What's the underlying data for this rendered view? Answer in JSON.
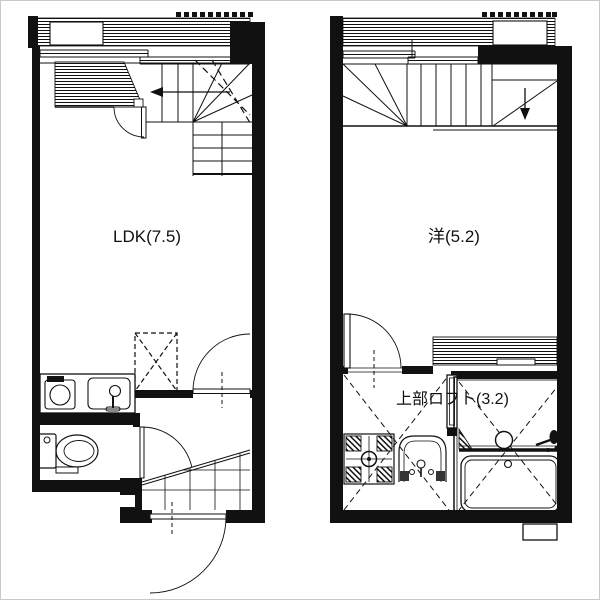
{
  "canvas": {
    "background": "#ffffff",
    "frame_color": "#c9c9c9",
    "ink": "#111111"
  },
  "plans": {
    "left": {
      "room_label": "LDK(7.5)",
      "fixtures": [
        "balcony-railing",
        "ac-unit",
        "staircase-up",
        "kitchen-stove",
        "kitchen-sink",
        "refrigerator-space",
        "toilet",
        "toilet-paper-holder",
        "entrance-porch-tiles",
        "entrance-door"
      ]
    },
    "right": {
      "room_label": "洋(5.2)",
      "loft_label": "上部ロフト(3.2)",
      "fixtures": [
        "balcony-railing",
        "ac-unit",
        "staircase-down",
        "loft-above-dashed",
        "washing-machine-pan",
        "washbasin",
        "bath-door",
        "unit-bath",
        "bathtub",
        "bath-counter",
        "bath-sink"
      ]
    }
  }
}
